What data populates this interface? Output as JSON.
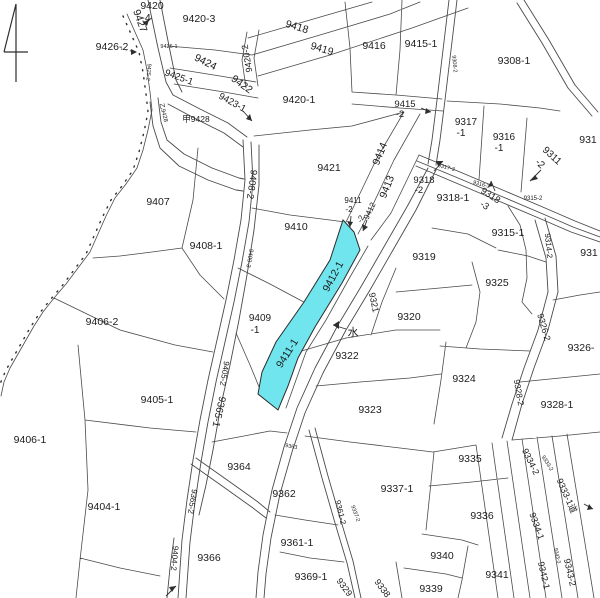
{
  "map": {
    "type": "cadastral-parcel-map",
    "background": "#ffffff",
    "line_color": "#4a4a4a",
    "highlight_color": "#70e5ee",
    "highlighted_parcels": [
      "9412-1",
      "9411-1"
    ],
    "water_mark": "水",
    "labels": [
      {
        "t": "9420",
        "x": 152,
        "y": 9,
        "r": 0,
        "s": 10.5
      },
      {
        "t": "-4",
        "x": 146,
        "y": 21,
        "r": 0,
        "s": 10.5
      },
      {
        "t": "9420-3",
        "x": 199,
        "y": 22,
        "r": 0,
        "s": 10.5
      },
      {
        "t": "9427",
        "x": 137,
        "y": 22,
        "r": 70,
        "s": 10.5
      },
      {
        "t": "9426-2",
        "x": 112,
        "y": 50,
        "r": 0,
        "s": 10.5
      },
      {
        "t": "9426-1",
        "x": 169,
        "y": 48,
        "r": 0,
        "s": 5.5
      },
      {
        "t": "9424",
        "x": 204,
        "y": 65,
        "r": 27,
        "s": 10.5
      },
      {
        "t": "9420-2",
        "x": 250,
        "y": 58,
        "r": -100,
        "s": 9
      },
      {
        "t": "9425-1",
        "x": 178,
        "y": 80,
        "r": 20,
        "s": 9.5
      },
      {
        "t": "9422",
        "x": 240,
        "y": 87,
        "r": 36,
        "s": 10.5
      },
      {
        "t": "9423-1",
        "x": 231,
        "y": 105,
        "r": 29,
        "s": 9.5
      },
      {
        "t": "甲9428",
        "x": 196,
        "y": 122,
        "r": 0,
        "s": 8.5
      },
      {
        "t": "乙9428",
        "x": 162,
        "y": 113,
        "r": 76,
        "s": 6
      },
      {
        "t": "9425-2",
        "x": 147,
        "y": 72,
        "r": 95,
        "s": 5.5
      },
      {
        "t": "9418",
        "x": 296,
        "y": 30,
        "r": 17,
        "s": 10.5
      },
      {
        "t": "9419",
        "x": 321,
        "y": 52,
        "r": 17,
        "s": 10.5
      },
      {
        "t": "9420-1",
        "x": 299,
        "y": 103,
        "r": 0,
        "s": 10.5
      },
      {
        "t": "9416",
        "x": 374,
        "y": 49,
        "r": 0,
        "s": 10.5
      },
      {
        "t": "9415-1",
        "x": 421,
        "y": 47,
        "r": 0,
        "s": 10.5
      },
      {
        "t": "9308-1",
        "x": 514,
        "y": 64,
        "r": 0,
        "s": 10.5
      },
      {
        "t": "9308-2",
        "x": 453,
        "y": 64,
        "r": 85,
        "s": 5.5
      },
      {
        "t": "9415",
        "x": 405,
        "y": 107,
        "r": 0,
        "s": 9.5
      },
      {
        "t": "-2",
        "x": 400,
        "y": 117,
        "r": 0,
        "s": 9.5
      },
      {
        "t": "9317",
        "x": 466,
        "y": 125,
        "r": 0,
        "s": 10
      },
      {
        "t": "-1",
        "x": 461,
        "y": 136,
        "r": 0,
        "s": 10
      },
      {
        "t": "9316",
        "x": 504,
        "y": 140,
        "r": 0,
        "s": 10
      },
      {
        "t": "-1",
        "x": 499,
        "y": 151,
        "r": 0,
        "s": 10
      },
      {
        "t": "9311",
        "x": 550,
        "y": 158,
        "r": 42,
        "s": 10
      },
      {
        "t": "-2",
        "x": 538,
        "y": 166,
        "r": 42,
        "s": 10
      },
      {
        "t": "931",
        "x": 588,
        "y": 143,
        "r": 0,
        "s": 10.5
      },
      {
        "t": "9317-3",
        "x": 446,
        "y": 169,
        "r": 14,
        "s": 5.5
      },
      {
        "t": "9316-3",
        "x": 481,
        "y": 186,
        "r": 15,
        "s": 5.5
      },
      {
        "t": "9318",
        "x": 424,
        "y": 183,
        "r": 0,
        "s": 9.5
      },
      {
        "t": "-2",
        "x": 419,
        "y": 193,
        "r": 0,
        "s": 9.5
      },
      {
        "t": "9318-1",
        "x": 453,
        "y": 201,
        "r": 0,
        "s": 10.5
      },
      {
        "t": "9318",
        "x": 489,
        "y": 198,
        "r": 33,
        "s": 9.5
      },
      {
        "t": "-3",
        "x": 483,
        "y": 208,
        "r": 33,
        "s": 9.5
      },
      {
        "t": "9315-2",
        "x": 533,
        "y": 200,
        "r": 0,
        "s": 6
      },
      {
        "t": "9315-1",
        "x": 508,
        "y": 236,
        "r": 0,
        "s": 10.5
      },
      {
        "t": "9314-2",
        "x": 546,
        "y": 246,
        "r": 85,
        "s": 8
      },
      {
        "t": "931",
        "x": 589,
        "y": 256,
        "r": 0,
        "s": 10.5
      },
      {
        "t": "9319",
        "x": 424,
        "y": 260,
        "r": 0,
        "s": 10.5
      },
      {
        "t": "9414",
        "x": 383,
        "y": 155,
        "r": -68,
        "s": 10.5
      },
      {
        "t": "9413",
        "x": 390,
        "y": 188,
        "r": -68,
        "s": 10.5
      },
      {
        "t": "9421",
        "x": 329,
        "y": 171,
        "r": 0,
        "s": 10.5
      },
      {
        "t": "9411",
        "x": 353,
        "y": 203,
        "r": 0,
        "s": 8
      },
      {
        "t": "-2",
        "x": 349,
        "y": 212,
        "r": 0,
        "s": 8
      },
      {
        "t": "9412",
        "x": 372,
        "y": 212,
        "r": -65,
        "s": 8
      },
      {
        "t": "-2",
        "x": 363,
        "y": 220,
        "r": -65,
        "s": 8
      },
      {
        "t": "9410",
        "x": 296,
        "y": 230,
        "r": 0,
        "s": 10.5
      },
      {
        "t": "9412-1",
        "x": 336,
        "y": 278,
        "r": -62,
        "s": 10.5
      },
      {
        "t": "9321",
        "x": 371,
        "y": 303,
        "r": 78,
        "s": 9
      },
      {
        "t": "9320",
        "x": 409,
        "y": 320,
        "r": 0,
        "s": 10.5
      },
      {
        "t": "9325",
        "x": 497,
        "y": 286,
        "r": 0,
        "s": 10.5
      },
      {
        "t": "9326-2",
        "x": 541,
        "y": 328,
        "r": 74,
        "s": 9
      },
      {
        "t": "9326-",
        "x": 581,
        "y": 351,
        "r": 0,
        "s": 10.5
      },
      {
        "t": "9409",
        "x": 260,
        "y": 321,
        "r": 0,
        "s": 10
      },
      {
        "t": "-1",
        "x": 255,
        "y": 333,
        "r": 0,
        "s": 10
      },
      {
        "t": "水",
        "x": 353,
        "y": 336,
        "r": 0,
        "s": 11
      },
      {
        "t": "9411-1",
        "x": 290,
        "y": 355,
        "r": -58,
        "s": 10.5
      },
      {
        "t": "9322",
        "x": 347,
        "y": 359,
        "r": 0,
        "s": 10.5
      },
      {
        "t": "9323",
        "x": 370,
        "y": 413,
        "r": 0,
        "s": 10.5
      },
      {
        "t": "9324",
        "x": 464,
        "y": 382,
        "r": 0,
        "s": 10.5
      },
      {
        "t": "9328-2",
        "x": 516,
        "y": 393,
        "r": 80,
        "s": 8.5
      },
      {
        "t": "9328-1",
        "x": 557,
        "y": 408,
        "r": 0,
        "s": 10.5
      },
      {
        "t": "9337-1",
        "x": 397,
        "y": 492,
        "r": 0,
        "s": 10.5
      },
      {
        "t": "9335",
        "x": 470,
        "y": 462,
        "r": 0,
        "s": 10.5
      },
      {
        "t": "9336",
        "x": 482,
        "y": 519,
        "r": 0,
        "s": 10.5
      },
      {
        "t": "9334-2",
        "x": 528,
        "y": 463,
        "r": 64,
        "s": 9
      },
      {
        "t": "9333-2",
        "x": 546,
        "y": 464,
        "r": 58,
        "s": 5.5
      },
      {
        "t": "9333-1道",
        "x": 564,
        "y": 497,
        "r": 66,
        "s": 9
      },
      {
        "t": "9334-1",
        "x": 534,
        "y": 527,
        "r": 70,
        "s": 9
      },
      {
        "t": "9364",
        "x": 239,
        "y": 470,
        "r": 0,
        "s": 10.5
      },
      {
        "t": "9363",
        "x": 291,
        "y": 448,
        "r": 10,
        "s": 5.5
      },
      {
        "t": "9362",
        "x": 284,
        "y": 497,
        "r": 0,
        "s": 10.5
      },
      {
        "t": "9361-2",
        "x": 338,
        "y": 513,
        "r": 76,
        "s": 8
      },
      {
        "t": "9337-2",
        "x": 354,
        "y": 514,
        "r": 70,
        "s": 5.5
      },
      {
        "t": "9361-1",
        "x": 297,
        "y": 546,
        "r": 0,
        "s": 10.5
      },
      {
        "t": "9366",
        "x": 209,
        "y": 561,
        "r": 0,
        "s": 10.5
      },
      {
        "t": "9369-1",
        "x": 311,
        "y": 580,
        "r": 0,
        "s": 10.5
      },
      {
        "t": "9340",
        "x": 442,
        "y": 559,
        "r": 0,
        "s": 10.5
      },
      {
        "t": "9341",
        "x": 497,
        "y": 578,
        "r": 0,
        "s": 10.5
      },
      {
        "t": "9339",
        "x": 431,
        "y": 592,
        "r": 0,
        "s": 10.5
      },
      {
        "t": "9329",
        "x": 342,
        "y": 589,
        "r": 54,
        "s": 9
      },
      {
        "t": "9338",
        "x": 380,
        "y": 590,
        "r": 54,
        "s": 9
      },
      {
        "t": "9342-1",
        "x": 541,
        "y": 576,
        "r": 77,
        "s": 9
      },
      {
        "t": "9343-2",
        "x": 567,
        "y": 573,
        "r": 77,
        "s": 9
      },
      {
        "t": "9343-3",
        "x": 556,
        "y": 556,
        "r": 77,
        "s": 5
      },
      {
        "t": "9405-1",
        "x": 157,
        "y": 403,
        "r": 0,
        "s": 10.5
      },
      {
        "t": "9406-1",
        "x": 30,
        "y": 443,
        "r": 0,
        "s": 10.5
      },
      {
        "t": "9404-1",
        "x": 104,
        "y": 510,
        "r": 0,
        "s": 10.5
      },
      {
        "t": "9406-2",
        "x": 102,
        "y": 325,
        "r": 0,
        "s": 10.5
      },
      {
        "t": "9407",
        "x": 158,
        "y": 205,
        "r": 0,
        "s": 10.5
      },
      {
        "t": "9408-1",
        "x": 206,
        "y": 249,
        "r": 0,
        "s": 10.5
      },
      {
        "t": "9408-2",
        "x": 249,
        "y": 184,
        "r": 98,
        "s": 9.5
      },
      {
        "t": "9409-3",
        "x": 248,
        "y": 258,
        "r": 100,
        "s": 6
      },
      {
        "t": "9405-2",
        "x": 222,
        "y": 373,
        "r": 100,
        "s": 8
      },
      {
        "t": "9365-1",
        "x": 216,
        "y": 411,
        "r": 103,
        "s": 10
      },
      {
        "t": "9365-2",
        "x": 190,
        "y": 501,
        "r": 100,
        "s": 8
      },
      {
        "t": "9404-2",
        "x": 172,
        "y": 558,
        "r": 95,
        "s": 8
      }
    ]
  }
}
